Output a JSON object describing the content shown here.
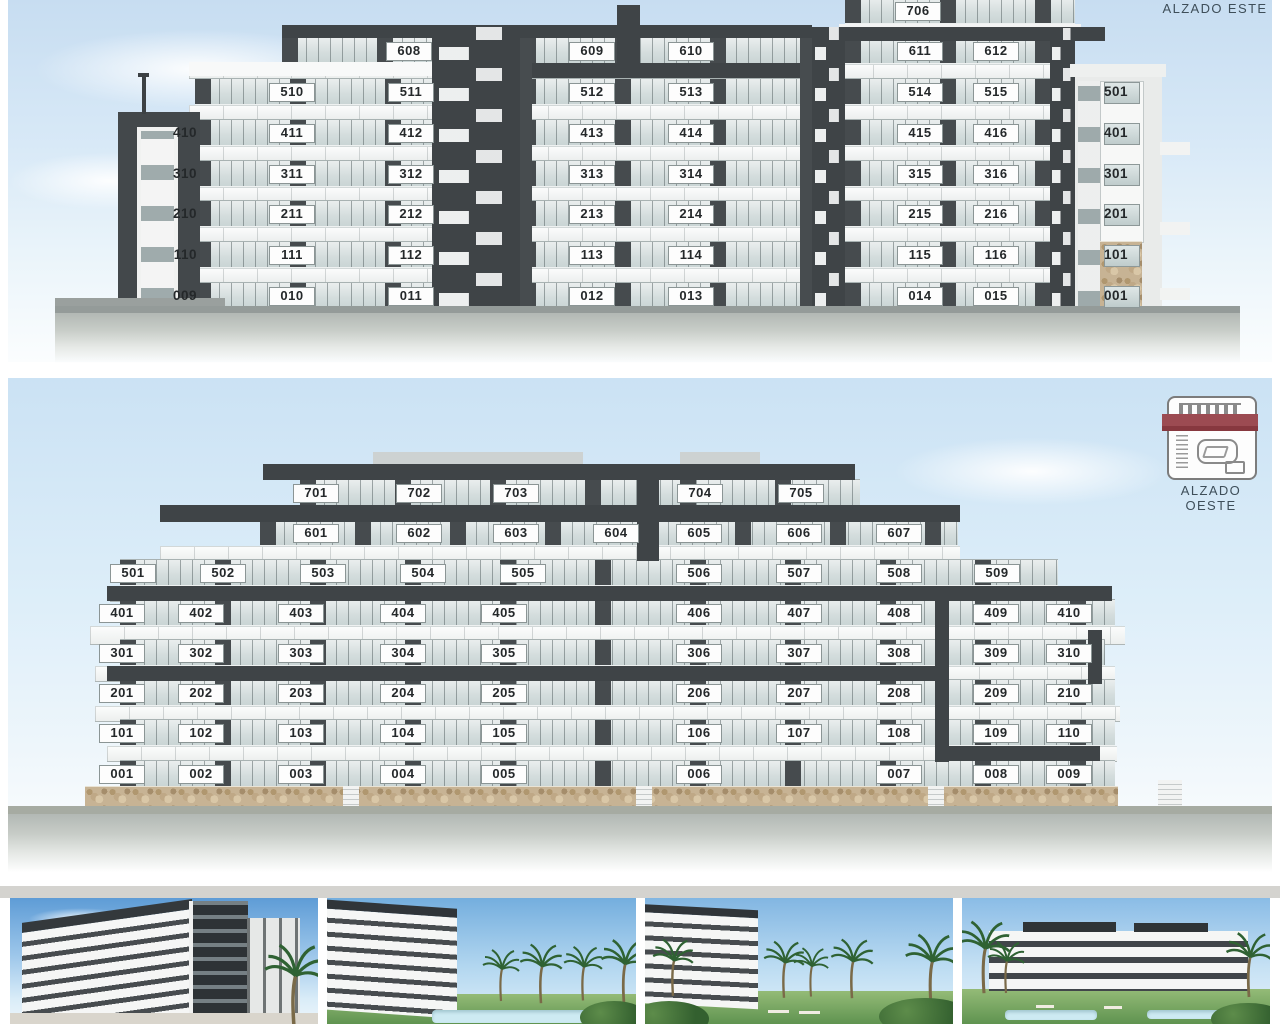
{
  "east": {
    "title": "ALZADO ESTE",
    "left_tower": {
      "floors": [
        4,
        3,
        2,
        1,
        0
      ],
      "units": [
        "410",
        "310",
        "210",
        "110",
        "009"
      ]
    },
    "right_tower": {
      "floors": [
        5,
        4,
        3,
        2,
        1,
        0
      ],
      "units": [
        "501",
        "401",
        "301",
        "201",
        "101",
        "001"
      ]
    },
    "sections": [
      {
        "id": "a",
        "rows": [
          {
            "floor": 6,
            "units": [
              "608"
            ]
          },
          {
            "floor": 5,
            "units": [
              "510",
              "511"
            ]
          },
          {
            "floor": 4,
            "units": [
              "411",
              "412"
            ]
          },
          {
            "floor": 3,
            "units": [
              "311",
              "312"
            ]
          },
          {
            "floor": 2,
            "units": [
              "211",
              "212"
            ]
          },
          {
            "floor": 1,
            "units": [
              "111",
              "112"
            ]
          },
          {
            "floor": 0,
            "units": [
              "010",
              "011"
            ]
          }
        ]
      },
      {
        "id": "b",
        "rows": [
          {
            "floor": 6,
            "units": [
              "609",
              "610"
            ]
          },
          {
            "floor": 5,
            "units": [
              "512",
              "513"
            ]
          },
          {
            "floor": 4,
            "units": [
              "413",
              "414"
            ]
          },
          {
            "floor": 3,
            "units": [
              "313",
              "314"
            ]
          },
          {
            "floor": 2,
            "units": [
              "213",
              "214"
            ]
          },
          {
            "floor": 1,
            "units": [
              "113",
              "114"
            ]
          },
          {
            "floor": 0,
            "units": [
              "012",
              "013"
            ]
          }
        ]
      },
      {
        "id": "c",
        "rows": [
          {
            "floor": 7,
            "units": [
              "706"
            ]
          },
          {
            "floor": 6,
            "units": [
              "611",
              "612"
            ]
          },
          {
            "floor": 5,
            "units": [
              "514",
              "515"
            ]
          },
          {
            "floor": 4,
            "units": [
              "415",
              "416"
            ]
          },
          {
            "floor": 3,
            "units": [
              "315",
              "316"
            ]
          },
          {
            "floor": 2,
            "units": [
              "215",
              "216"
            ]
          },
          {
            "floor": 1,
            "units": [
              "115",
              "116"
            ]
          },
          {
            "floor": 0,
            "units": [
              "014",
              "015"
            ]
          }
        ]
      }
    ]
  },
  "west": {
    "title": "ALZADO OESTE",
    "icon": "site-plan-icon",
    "accent_color": "#9c4b52",
    "floors": [
      {
        "floor": 7,
        "units": [
          "701",
          "702",
          "703",
          "704",
          "705"
        ]
      },
      {
        "floor": 6,
        "units": [
          "601",
          "602",
          "603",
          "604",
          "605",
          "606",
          "607"
        ]
      },
      {
        "floor": 5,
        "units": [
          "501",
          "502",
          "503",
          "504",
          "505",
          "506",
          "507",
          "508",
          "509"
        ]
      },
      {
        "floor": 4,
        "units": [
          "401",
          "402",
          "403",
          "404",
          "405",
          "406",
          "407",
          "408",
          "409",
          "410"
        ]
      },
      {
        "floor": 3,
        "units": [
          "301",
          "302",
          "303",
          "304",
          "305",
          "306",
          "307",
          "308",
          "309",
          "310"
        ]
      },
      {
        "floor": 2,
        "units": [
          "201",
          "202",
          "203",
          "204",
          "205",
          "206",
          "207",
          "208",
          "209",
          "210"
        ]
      },
      {
        "floor": 1,
        "units": [
          "101",
          "102",
          "103",
          "104",
          "105",
          "106",
          "107",
          "108",
          "109",
          "110"
        ]
      },
      {
        "floor": 0,
        "units": [
          "001",
          "002",
          "003",
          "004",
          "005",
          "006",
          "007",
          "008",
          "009"
        ]
      }
    ]
  },
  "photos": [
    {
      "name": "render-building-corner"
    },
    {
      "name": "render-building-palms"
    },
    {
      "name": "render-garden-palms"
    },
    {
      "name": "render-building-pool"
    }
  ],
  "colors": {
    "sky_top": "#c7ddf1",
    "dark_facade": "#3f4447",
    "glass": "#ccd6d6",
    "slab": "#f6f7f7",
    "stone": "#c7b394",
    "ground": "#a6aba2",
    "label_text": "#24282a",
    "title_text": "#3e4e59",
    "accent": "#9c4b52"
  }
}
